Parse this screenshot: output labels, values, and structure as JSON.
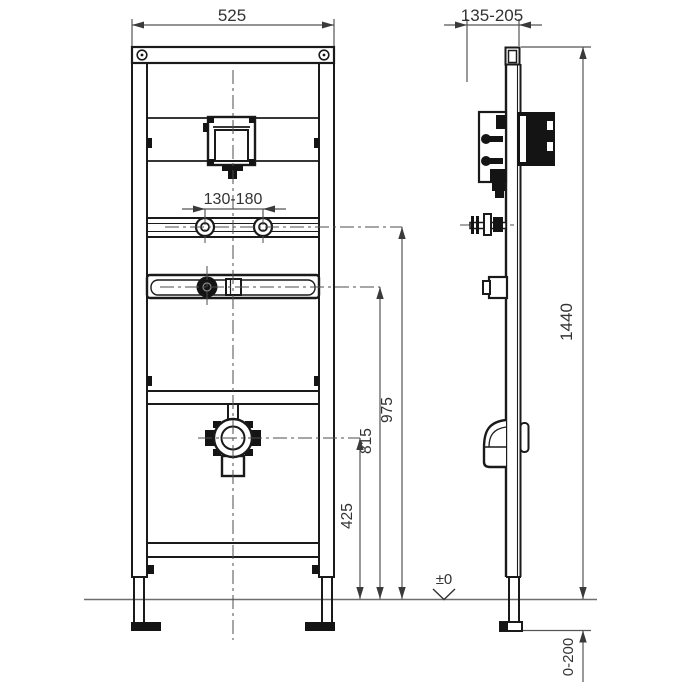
{
  "dimensions": {
    "frame_width": "525",
    "wall_distance_range": "135-205",
    "fixing_bolt_spacing": "130-180",
    "frame_height": "1440",
    "fixing_height": "975",
    "water_inlet_height": "815",
    "drain_height": "425",
    "floor_level": "±0",
    "foot_adjustment_range": "0-200"
  },
  "colors": {
    "background": "#ffffff",
    "line": "#1a1a1a",
    "dimension_line": "#555555",
    "text": "#333333"
  }
}
